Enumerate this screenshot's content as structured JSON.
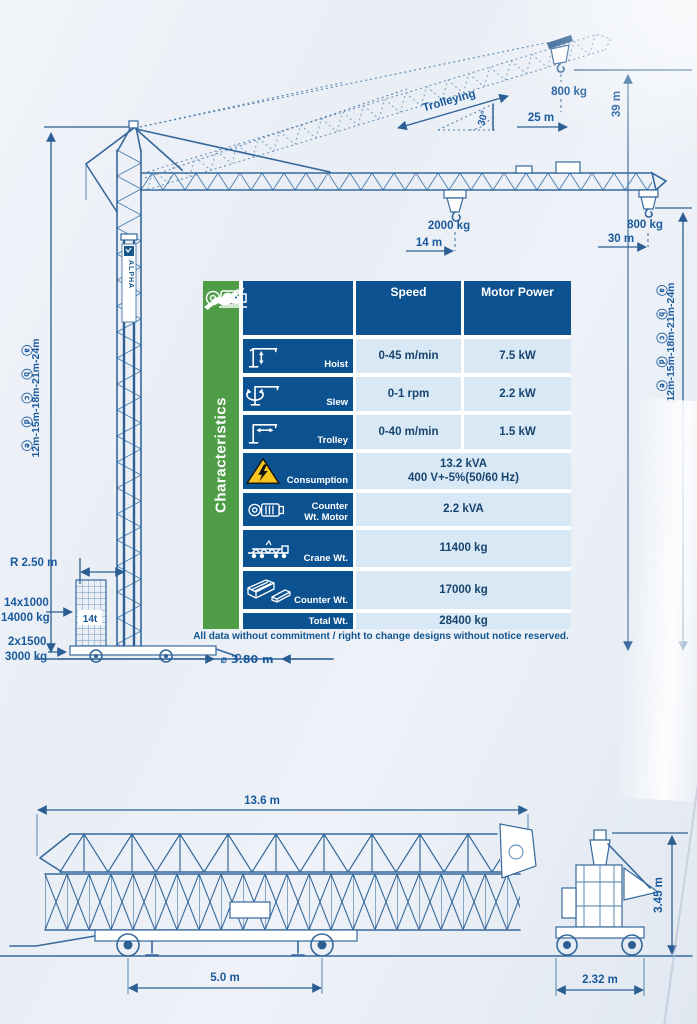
{
  "colors": {
    "accent_blue": "#0d5290",
    "line_blue": "#35689c",
    "green": "#4f9e47",
    "row_light_blue": "#d9e8f5",
    "warning_yellow": "#f7c51e",
    "text_blue": "#17456f"
  },
  "drawing": {
    "brand": "ALPHA",
    "trolleying_label": "Trolleying",
    "raised_angle": "30°",
    "raised_radius": "25 m",
    "raised_hook_load": "800 kg",
    "raised_hook_height": "39 m",
    "mid_hook_load": "2000 kg",
    "mid_hook_radius": "14 m",
    "tip_hook_load": "800 kg",
    "tip_hook_radius": "30 m",
    "right_markers": "ⓐ ⓑ ⓒ ⓓ ⓔ",
    "right_heights": "12m-15m-18m-21m-24m",
    "left_markers": "ⓐ ⓑ ⓒ ⓓ ⓔ",
    "left_heights": "12m-15m-18m-21m-24m",
    "slew_radius": "R 2.50 m",
    "tower_ballast_count": "14x1000",
    "tower_ballast_weight": "14000 kg",
    "tower_ballast_label": "14t",
    "base_ballast_count": "2x1500",
    "base_ballast_weight": "3000 kg",
    "base_diameter": "⌀ 3.80 m"
  },
  "table": {
    "side_title": "Characteristics",
    "col_speed": "Speed",
    "col_power": "Motor Power",
    "rows": {
      "hoist": {
        "label": "Hoist",
        "speed": "0-45 m/min",
        "power": "7.5 kW"
      },
      "slew": {
        "label": "Slew",
        "speed": "0-1 rpm",
        "power": "2.2 kW"
      },
      "trolley": {
        "label": "Trolley",
        "speed": "0-40 m/min",
        "power": "1.5 kW"
      },
      "consumption": {
        "label": "Consumption",
        "value1": "13.2 kVA",
        "value2": "400 V+-5%(50/60 Hz)"
      },
      "counter_wt_motor": {
        "label1": "Counter",
        "label2": "Wt. Motor",
        "value": "2.2 kVA"
      },
      "crane_wt": {
        "label": "Crane Wt.",
        "value": "11400 kg"
      },
      "counter_wt": {
        "label": "Counter Wt.",
        "value": "17000 kg"
      },
      "total_wt": {
        "label": "Total Wt.",
        "value": "28400 kg"
      }
    },
    "footnote": "All data without commitment / right to change designs without notice reserved."
  },
  "transport": {
    "length": "13.6 m",
    "wheelbase": "5.0 m",
    "width": "2.32 m",
    "height": "3.45 m"
  }
}
